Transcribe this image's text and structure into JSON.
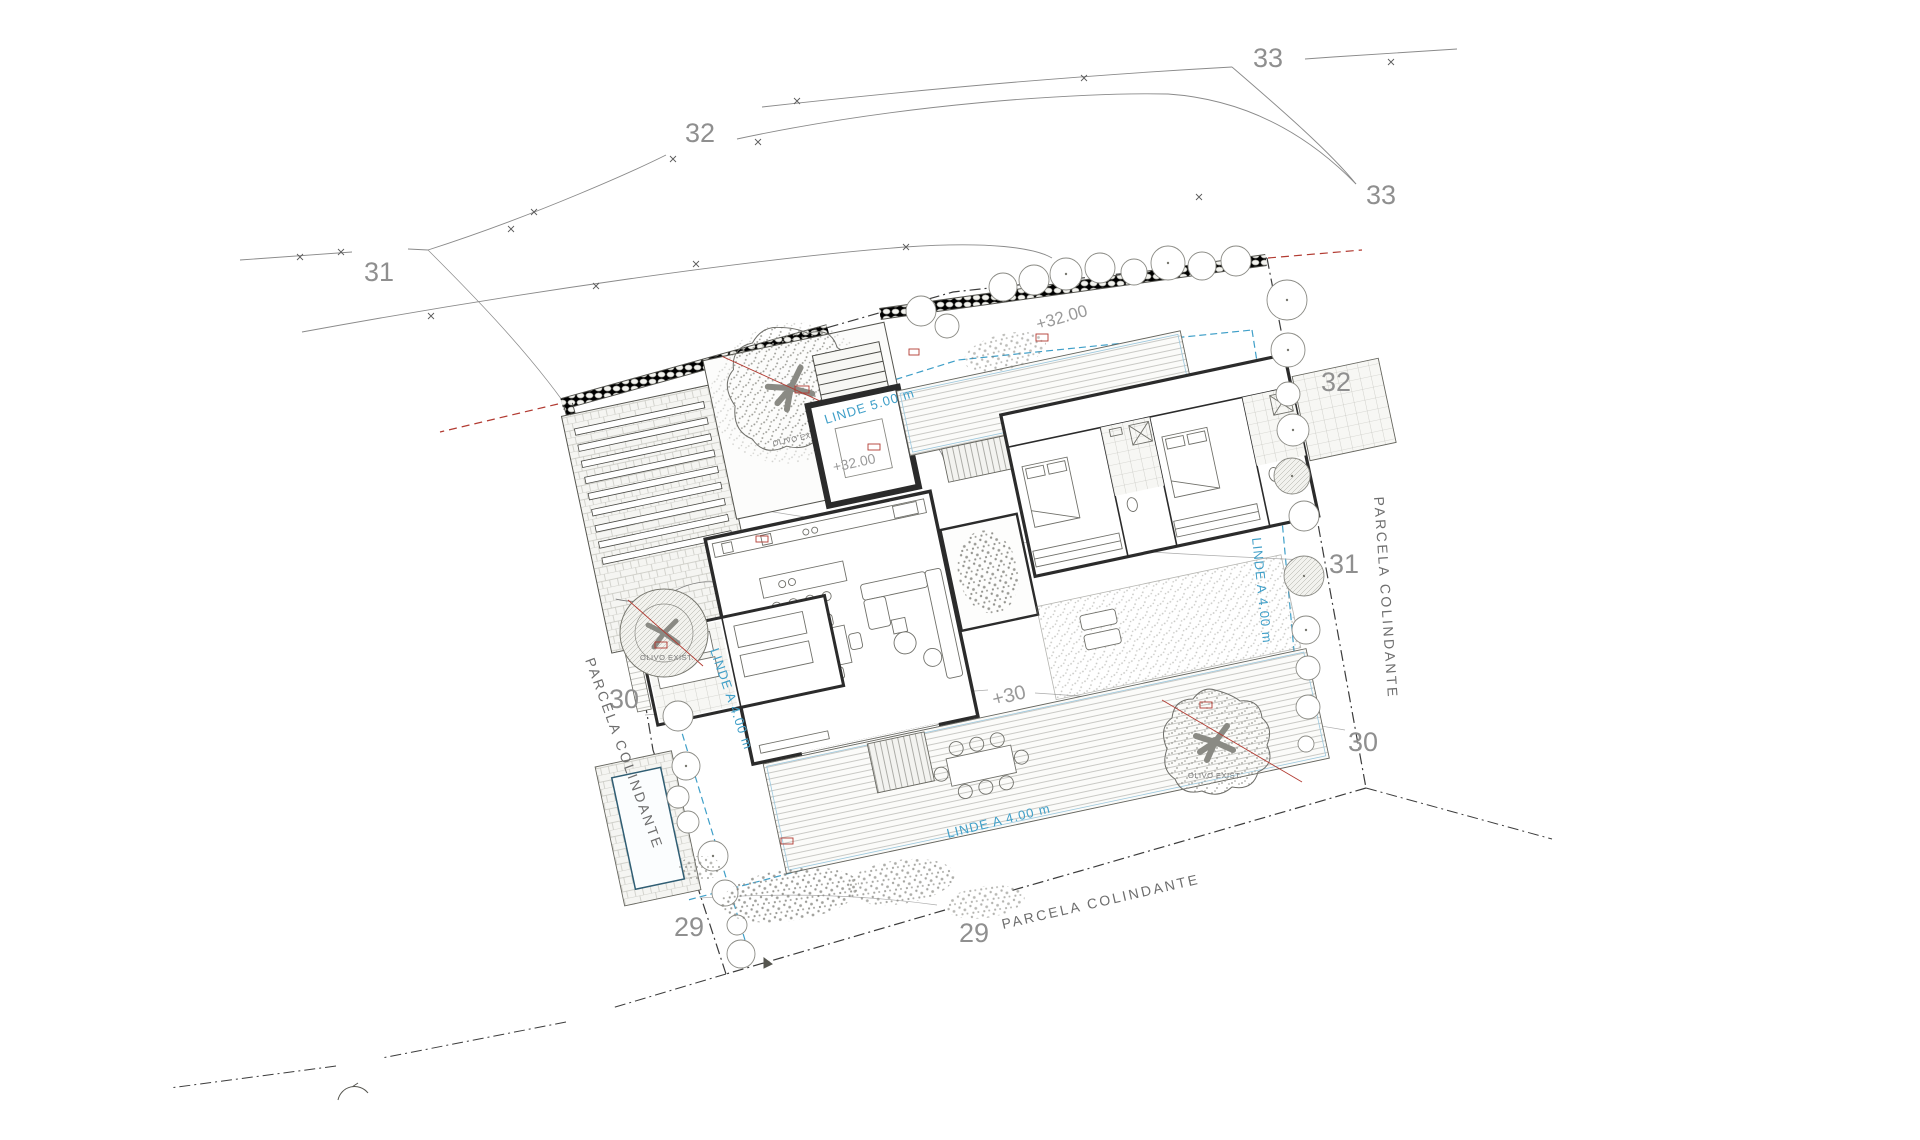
{
  "drawing": {
    "labels": {
      "contour_33_top": "33",
      "contour_33_right": "33",
      "contour_32_top": "32",
      "contour_32_right": "32",
      "contour_31_left": "31",
      "contour_31_right": "31",
      "contour_30_left": "30",
      "contour_30_right": "30",
      "contour_29_left": "29",
      "contour_29_bottom": "29"
    },
    "parcel": {
      "left": "PARCELA COLINDANTE",
      "right": "PARCELA COLINDANTE",
      "bottom": "PARCELA COLINDANTE"
    },
    "setbacks": {
      "top": "LINDE  5.00 m",
      "right": "LINDE A 4.00 m",
      "bottom": "LINDE A 4.00 m",
      "left": "LINDE A 4.00 m"
    },
    "levels": {
      "top_area": "+32.00",
      "entrance": "+32.00",
      "deck": "+30"
    },
    "trees": {
      "courtyard": "OLIVO EXIST.",
      "south": "OLIVO EXIST.",
      "west": "OLIVO EXIST."
    },
    "colors": {
      "setback_blue": "#3f9fc8",
      "accent_red": "#b23b32",
      "contour_gray": "#8f8f8f",
      "wall_black": "#2b2b2b"
    }
  }
}
